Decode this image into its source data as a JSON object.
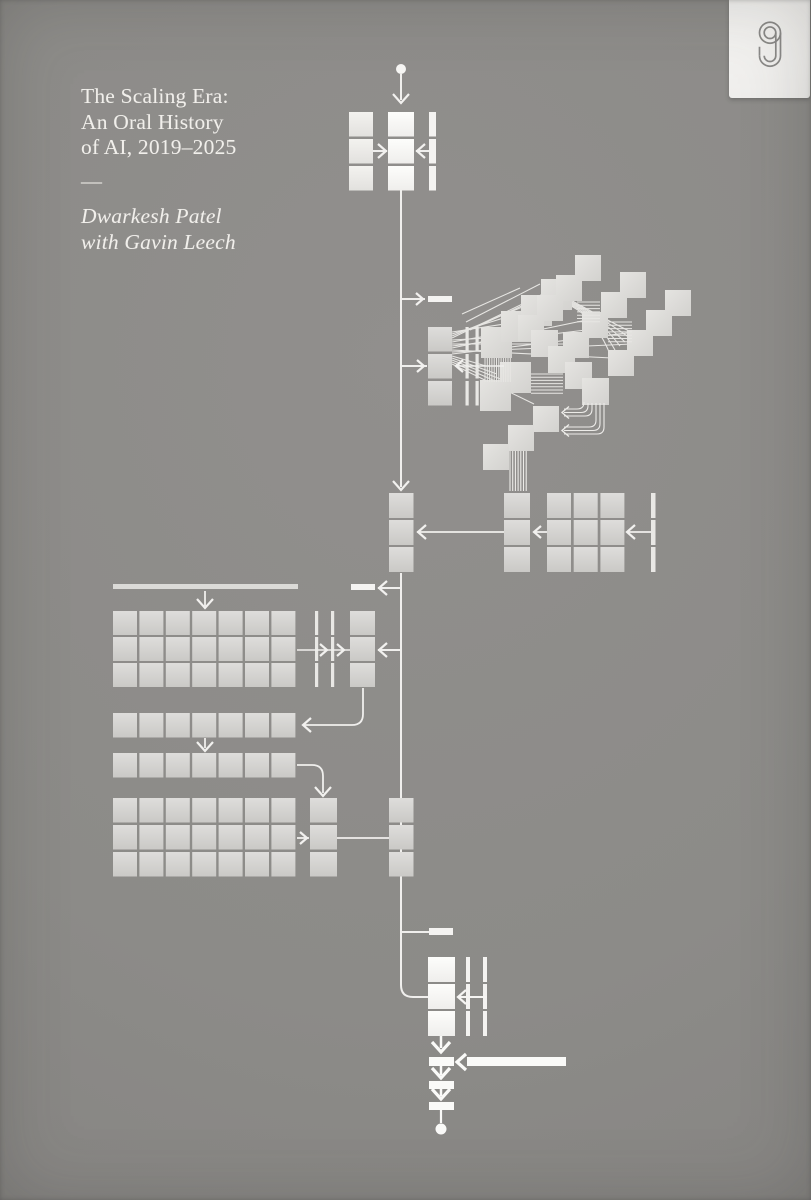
{
  "cover": {
    "title_lines": [
      "The Scaling Era:",
      "An Oral History",
      "of AI, 2019–2025"
    ],
    "divider": "—",
    "author_lines": [
      "Dwarkesh Patel",
      "with Gavin Leech"
    ],
    "icons": {
      "publisher_logo": "stripe-press-s-monogram",
      "diagram_motifs": [
        "start-dot",
        "down-arrow",
        "left-arrow",
        "right-arrow",
        "block-grid",
        "staircase-chain",
        "end-dot"
      ]
    },
    "colors": {
      "background": "#8c8b88",
      "block_gray": "#d6d5d2",
      "block_white": "#fbfaf8",
      "stair_block": "#dcdbd8",
      "line": "#f0efed",
      "text": "#f1efeb",
      "tab": "#f4f3f1",
      "logo_mark": "#8b8a88"
    }
  }
}
